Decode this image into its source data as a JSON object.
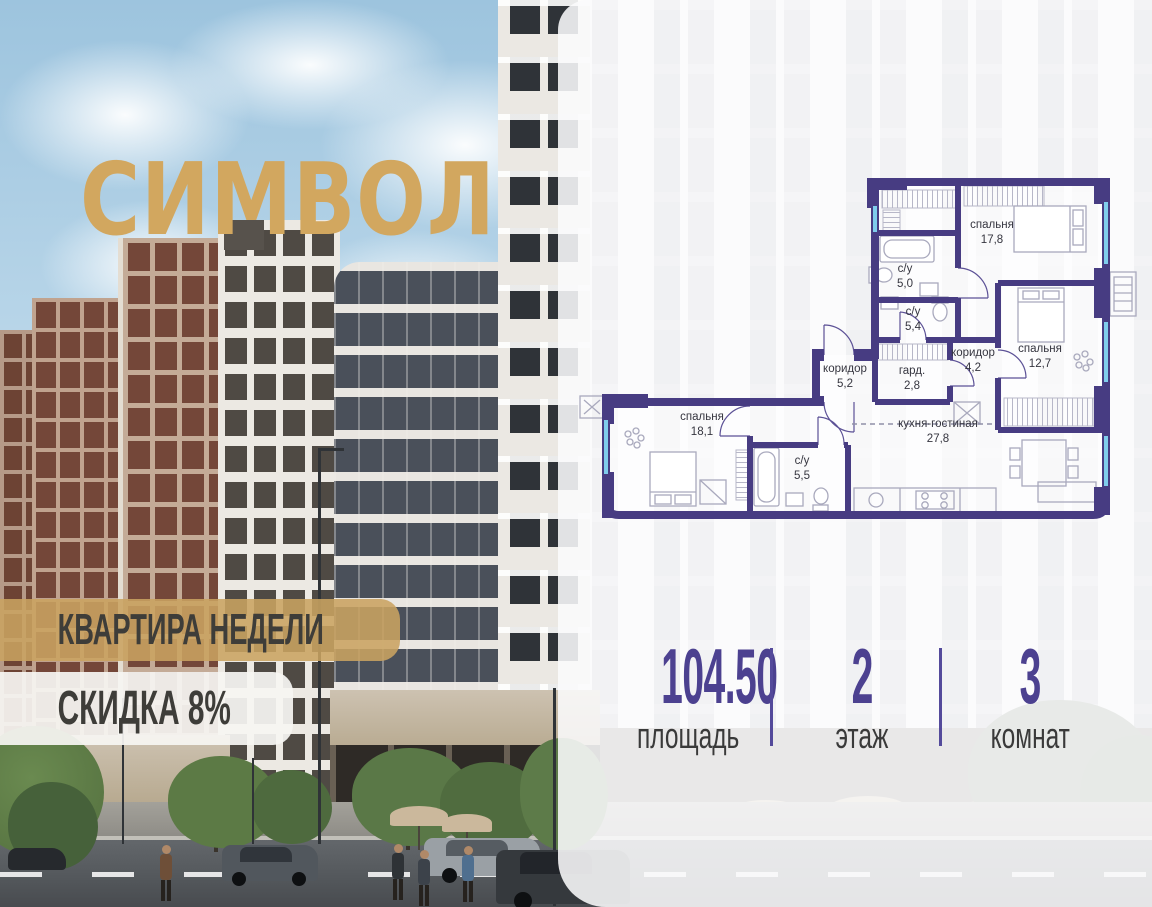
{
  "brand": {
    "logo": "СИМВОЛ"
  },
  "badges": {
    "weekly": "КВАРТИРА НЕДЕЛИ",
    "discount": "СКИДКА 8%"
  },
  "floorplan": {
    "rooms": [
      {
        "name": "спальня",
        "area": "17,8",
        "x": 992,
        "y": 228
      },
      {
        "name": "с/у",
        "area": "5,0",
        "x": 905,
        "y": 272
      },
      {
        "name": "с/у",
        "area": "5,4",
        "x": 913,
        "y": 315
      },
      {
        "name": "коридор",
        "area": "5,2",
        "x": 845,
        "y": 372
      },
      {
        "name": "гард.",
        "area": "2,8",
        "x": 912,
        "y": 374
      },
      {
        "name": "коридор",
        "area": "4,2",
        "x": 973,
        "y": 356
      },
      {
        "name": "спальня",
        "area": "12,7",
        "x": 1040,
        "y": 352
      },
      {
        "name": "спальня",
        "area": "18,1",
        "x": 702,
        "y": 420
      },
      {
        "name": "с/у",
        "area": "5,5",
        "x": 802,
        "y": 464
      },
      {
        "name": "кухня-гостиная",
        "area": "27,8",
        "x": 938,
        "y": 427
      }
    ]
  },
  "stats": [
    {
      "value": "104.50",
      "label": "площадь"
    },
    {
      "value": "2",
      "label": "этаж"
    },
    {
      "value": "3",
      "label": "комнат"
    }
  ],
  "colors": {
    "accent_gold": "#d2a75f",
    "plan_wall": "#473c82",
    "stat_number": "#4c4190",
    "window_glass": "#7fcdec"
  }
}
